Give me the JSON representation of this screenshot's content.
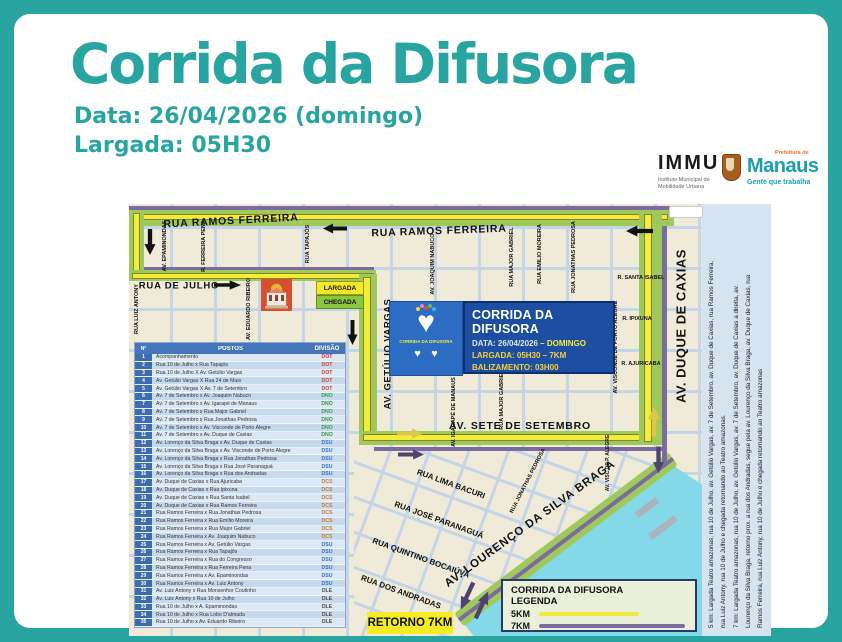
{
  "header": {
    "title": "Corrida da Difusora",
    "date_line": "Data: 26/04/2026 (domingo)",
    "start_line": "Largada: 05H30"
  },
  "logos": {
    "immu": {
      "name": "IMMU",
      "subtitle1": "Instituto Municipal de",
      "subtitle2": "Mobilidade Urbana"
    },
    "manaus": {
      "pre": "Prefeitura de",
      "name": "Manaus",
      "tagline": "Gente que trabalha"
    }
  },
  "colors": {
    "accent_teal": "#29a5a1",
    "route_5km_yellow": "#f4ec3b",
    "route_7km_purple": "#7c6b9e",
    "route_band_green": "#9fc95c",
    "water_cyan": "#84d9e8",
    "info_box_blue": "#1c4fa1"
  },
  "map": {
    "info_box": {
      "title": "CORRIDA DA DIFUSORA",
      "date_label": "DATA: 26/04/2026 –",
      "date_value": "DOMINGO",
      "line2": "LARGADA: 05H30 – 7KM",
      "line3": "BALIZAMENTO: 03H00"
    },
    "logo_box": {
      "caption": "CORRIDA DA DIFUSORA"
    },
    "markers": {
      "largada": "LARGADA",
      "chegada": "CHEGADA",
      "retorno": "RETORNO 7KM"
    },
    "legend": {
      "title": "CORRIDA DA DIFUSORA",
      "subtitle": "LEGENDA",
      "items": [
        {
          "label": "5KM",
          "color": "#f2e93a"
        },
        {
          "label": "7KM",
          "color": "#7e6b9d"
        }
      ]
    },
    "street_labels": [
      {
        "t": "RUA RAMOS FERREIRA",
        "x": 102,
        "y": 17,
        "r": -3,
        "s": 10.5,
        "ls": 0.8
      },
      {
        "t": "RUA RAMOS FERREIRA",
        "x": 310,
        "y": 27,
        "r": -2,
        "s": 10.5,
        "ls": 0.8
      },
      {
        "t": "RUA DE JULHO",
        "x": 50,
        "y": 82,
        "r": 0,
        "s": 9.5,
        "ls": 0.8
      },
      {
        "t": "AV. SETE DE SETEMBRO",
        "x": 391,
        "y": 222,
        "r": 0,
        "s": 10.5,
        "ls": 0.8
      },
      {
        "t": "AV. GETÚLIO VARGAS",
        "x": 259,
        "y": 150,
        "r": -90,
        "s": 9.5,
        "ls": 0.5
      },
      {
        "t": "AV. DUQUE DE CAXIAS",
        "x": 552,
        "y": 122,
        "r": -90,
        "s": 13,
        "ls": 0.5
      },
      {
        "t": "AV. LOURENÇO DA SILVA BRAGA",
        "x": 401,
        "y": 320,
        "r": -36,
        "s": 11.5,
        "ls": 0.8
      },
      {
        "t": "AV. EPAMINONDAS",
        "x": 36,
        "y": 42,
        "r": -90,
        "s": 5.5
      },
      {
        "t": "R. FERREIRA PENA",
        "x": 75,
        "y": 42,
        "r": -90,
        "s": 5.5
      },
      {
        "t": "RUA TAPAJÓS",
        "x": 179,
        "y": 40,
        "r": -90,
        "s": 5.5
      },
      {
        "t": "RUA LUIZ ANTONY",
        "x": 8,
        "y": 105,
        "r": -90,
        "s": 5.5
      },
      {
        "t": "AV. EDUARDO RIBEIRO",
        "x": 120,
        "y": 105,
        "r": -90,
        "s": 5.5
      },
      {
        "t": "AV. JOAQUIM NABUCO",
        "x": 304,
        "y": 60,
        "r": -90,
        "s": 5.5
      },
      {
        "t": "RUA MAJOR GABRIEL",
        "x": 383,
        "y": 53,
        "r": -90,
        "s": 5.5
      },
      {
        "t": "RUA EMILIO MOREIRA",
        "x": 411,
        "y": 50,
        "r": -90,
        "s": 5.5
      },
      {
        "t": "RUA JONATHAS PEDROSA",
        "x": 445,
        "y": 53,
        "r": -90,
        "s": 5.5
      },
      {
        "t": "AV. IGARAPÉ DE MANAUS",
        "x": 325,
        "y": 208,
        "r": -90,
        "s": 5.5
      },
      {
        "t": "RUA MAJOR GABRIEL",
        "x": 373,
        "y": 196,
        "r": -90,
        "s": 5.5
      },
      {
        "t": "AV. VISCONDE DE PORTO ALEGRE",
        "x": 487,
        "y": 143,
        "r": -90,
        "s": 5.5
      },
      {
        "t": "AV. VISC DE P. ALEGRE",
        "x": 479,
        "y": 259,
        "r": -90,
        "s": 5
      },
      {
        "t": "R. SANTA ISABEL",
        "x": 512,
        "y": 74,
        "r": 0,
        "s": 5.5
      },
      {
        "t": "R. IPIXUNA",
        "x": 508,
        "y": 115,
        "r": 0,
        "s": 5.5
      },
      {
        "t": "R. AJURICABA",
        "x": 512,
        "y": 160,
        "r": 0,
        "s": 5.5
      },
      {
        "t": "RUA LIMA BACURI",
        "x": 322,
        "y": 280,
        "r": 20,
        "s": 8
      },
      {
        "t": "RUA JOSÉ PARANAGUÁ",
        "x": 310,
        "y": 316,
        "r": 20,
        "s": 8
      },
      {
        "t": "RUA QUINTINO BOCAIÚVA",
        "x": 292,
        "y": 354,
        "r": 20,
        "s": 8
      },
      {
        "t": "RUA DOS ANDRADAS",
        "x": 272,
        "y": 388,
        "r": 20,
        "s": 8
      },
      {
        "t": "RUA JONATHAS PEDROSA",
        "x": 399,
        "y": 277,
        "r": -63,
        "s": 5.5
      }
    ],
    "route_notes": [
      "5 km: Largada Teatro amazonas, rua 10 de Julho, av. Getúlio Vargas, av. 7 de Setembro, av. Duque de Caxias, rua Ramos Ferreira,",
      "rua Luiz Antony, rua 10 de Julho e chegada retornando ao Teatro amazonas.",
      "7 km: Largada Teatro amazonas, rua 10 de Julho, av. Getúlio Vargas, av. 7 de Setembro, av. Duque de Caxias a direita, av.",
      "Lourenço da Silva Braga, retorno prox. a rua dos Andradas, segue pela av. Lourenço da Silva Braga, av. Duque de Caxias, rua",
      "Ramos Ferreira, rua Luiz Antony, rua 10 de Julho e chegada retornando ao Teatro amazonas"
    ]
  },
  "table": {
    "headers": [
      "N°",
      "POSTOS",
      "DIVISÃO"
    ],
    "division_colors": {
      "DOT": "#e03a2f",
      "DNO": "#2e9e45",
      "DSU": "#2e74d6",
      "DCS": "#c97c25",
      "DLE": "#4d4d4d"
    },
    "rows": [
      {
        "n": "1",
        "posto": "Acompanhamento",
        "div": "DOT"
      },
      {
        "n": "2",
        "posto": "Rua 10 de Julho x Rua Tapajós",
        "div": "DOT"
      },
      {
        "n": "3",
        "posto": "Rua 10 de Julho X Av. Getúlio Vargas",
        "div": "DOT"
      },
      {
        "n": "4",
        "posto": "Av. Getúlio Vargas X Rua 24 de Maio",
        "div": "DOT"
      },
      {
        "n": "5",
        "posto": "Av. Getúlio Vargas X Av. 7 de Setembro",
        "div": "DOT"
      },
      {
        "n": "6",
        "posto": "Av. 7 de Setembro x Av. Joaquim Nabuco",
        "div": "DNO"
      },
      {
        "n": "7",
        "posto": "Av. 7 de Setembro x Av. Igarapé de Manaus",
        "div": "DNO"
      },
      {
        "n": "8",
        "posto": "Av. 7 de Setembro x Rua Major Gabriel",
        "div": "DNO"
      },
      {
        "n": "9",
        "posto": "Av. 7 de Setembro x Rua Jonathas Pedrosa",
        "div": "DNO"
      },
      {
        "n": "10",
        "posto": "Av. 7 de Setembro x Av. Visconde de Porto Alegre",
        "div": "DNO"
      },
      {
        "n": "11",
        "posto": "Av. 7 de Setembro x Av. Duque de Caxias",
        "div": "DNO"
      },
      {
        "n": "12",
        "posto": "Av. Lorenço da Silva Braga x Av. Duque de Caxias",
        "div": "DSU"
      },
      {
        "n": "13",
        "posto": "Av. Lorenço da Silva Braga x Av. Visconde de Porto Alegre",
        "div": "DSU"
      },
      {
        "n": "14",
        "posto": "Av. Lorenço da Silva Braga x Rua Jonathas Pedrosa",
        "div": "DSU"
      },
      {
        "n": "15",
        "posto": "Av. Lorenço da Silva Braga x Rua José Paranaguá",
        "div": "DSU"
      },
      {
        "n": "16",
        "posto": "Av. Lorenço da Silva Braga x Rua dos Andradas",
        "div": "DSU"
      },
      {
        "n": "17",
        "posto": "Av. Duque de Caxias x Rua Ajuricaba",
        "div": "DCS"
      },
      {
        "n": "18",
        "posto": "Av. Duque de Caxias x Rua Ipixuna",
        "div": "DCS"
      },
      {
        "n": "19",
        "posto": "Av. Duque de Caxias x Rua Santa Isabel",
        "div": "DCS"
      },
      {
        "n": "20",
        "posto": "Av. Duque de Caxias x Rua Ramos Ferreira",
        "div": "DCS"
      },
      {
        "n": "21",
        "posto": "Rua Ramos Ferreira x Rua Jonathas Pedrosa",
        "div": "DCS"
      },
      {
        "n": "22",
        "posto": "Rua Ramos Ferreira x Rua Emílio Moreira",
        "div": "DCS"
      },
      {
        "n": "23",
        "posto": "Rua Ramos Ferreira x Rua Major Gabriel",
        "div": "DCS"
      },
      {
        "n": "24",
        "posto": "Rua Ramos Ferreira x Av. Joaquim Nabuco",
        "div": "DCS"
      },
      {
        "n": "25",
        "posto": "Rua Ramos Ferreira x Av. Getúlio Vargas",
        "div": "DSU"
      },
      {
        "n": "26",
        "posto": "Rua Ramos Ferreira x Rua Tapajós",
        "div": "DSU"
      },
      {
        "n": "27",
        "posto": "Rua Ramos Ferreira x Rua do Congresso",
        "div": "DSU"
      },
      {
        "n": "28",
        "posto": "Rua Ramos Ferreira x Rua Ferreira Pena",
        "div": "DSU"
      },
      {
        "n": "29",
        "posto": "Rua Ramos Ferreira x Av. Epaminondas",
        "div": "DSU"
      },
      {
        "n": "30",
        "posto": "Rua Ramos Ferreira x Av. Luiz Antony",
        "div": "DSU"
      },
      {
        "n": "31",
        "posto": "Av. Luiz Antony x Rua Monsenhor Coutinho",
        "div": "DLE"
      },
      {
        "n": "32",
        "posto": "Av. Luiz Antony x Rua 10 de Julho",
        "div": "DLE"
      },
      {
        "n": "33",
        "posto": "Rua 10 de Julho x A. Epaminondas",
        "div": "DLE"
      },
      {
        "n": "34",
        "posto": "Rua 10 de Julho x Rua Lobo D'almada",
        "div": "DLE"
      },
      {
        "n": "35",
        "posto": "Rua 10 de Julho x Av. Eduardo Ribeiro",
        "div": "DLE"
      }
    ]
  }
}
